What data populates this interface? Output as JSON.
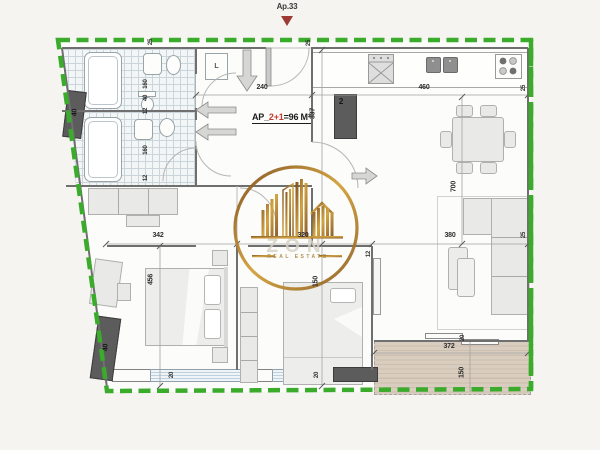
{
  "header": {
    "unit_label": "Ap.33"
  },
  "unit_info": {
    "prefix": "AP_",
    "rooms": "2+1",
    "area_suffix": "=96 M²"
  },
  "watermark": {
    "brand": "ZON",
    "tagline": "REAL ESTATE"
  },
  "appliances": {
    "washer": "L"
  },
  "columns": {
    "top_left": "40",
    "bottom_left": "40",
    "kitchen": "2"
  },
  "dims": {
    "hall_width": "240",
    "kitchen_width": "460",
    "hall_depth": "337",
    "bed1_width": "342",
    "bed2_width": "320",
    "living_width": "380",
    "bed1_depth": "456",
    "living_depth": "700",
    "bed2_depth": "150",
    "terrace_width": "372",
    "terrace_depth": "150",
    "bath1_d1": "160",
    "bath1_d2": "40",
    "bath1_d3": "12",
    "bath2_d1": "160",
    "bath2_d2": "12",
    "bed2_wall": "12",
    "wall_top_left": "25",
    "wall_entry": "25",
    "wall_right_top": "25",
    "wall_right_mid": "25",
    "window1": "20",
    "window2": "20",
    "balcony_door": "20"
  },
  "icons": {
    "unit_marker": "filled-down-triangle",
    "entry_arrow": "down-arrow",
    "door_arrows": "direction-arrows"
  },
  "colors": {
    "boundary_green": "#3aab2b",
    "watermark_gold": "#b8862b",
    "accent_red": "#c23b2e",
    "column_gray": "#5c5c5c"
  }
}
